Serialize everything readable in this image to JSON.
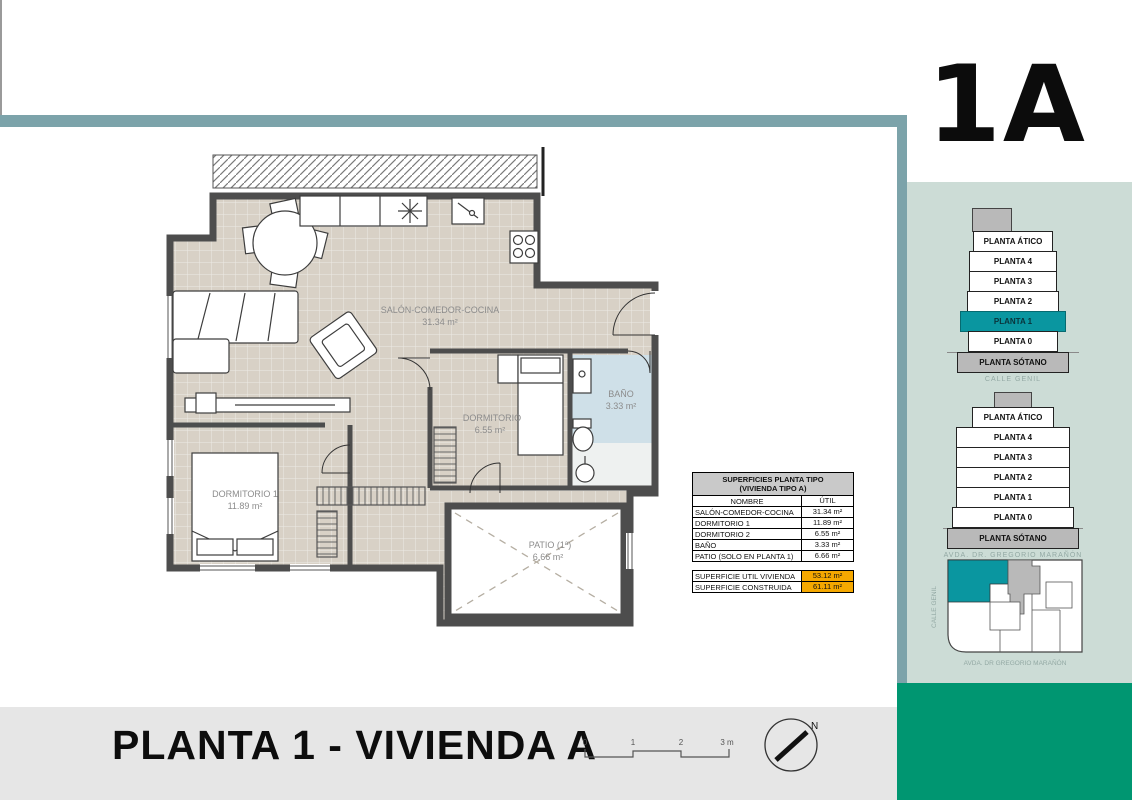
{
  "unit_label": "1A",
  "sheet_title": "PLANTA 1 - VIVIENDA A",
  "plan": {
    "rooms": [
      {
        "name": "SALÓN-COMEDOR-COCINA",
        "area": "31.34 m²"
      },
      {
        "name": "DORMITORIO",
        "area": "6.55 m²"
      },
      {
        "name": "DORMITORIO 1",
        "area": "11.89 m²"
      },
      {
        "name": "BAÑO",
        "area": "3.33 m²"
      },
      {
        "name": "PATIO (1ª)",
        "area": "6.66 m²"
      }
    ]
  },
  "table": {
    "title_line1": "SUPERFICIES PLANTA TIPO",
    "title_line2": "(VIVIENDA TIPO A)",
    "col_name": "NOMBRE",
    "col_util": "ÚTIL",
    "rows": [
      {
        "name": "SALÓN-COMEDOR-COCINA",
        "util": "31.34 m²"
      },
      {
        "name": "DORMITORIO 1",
        "util": "11.89 m²"
      },
      {
        "name": "DORMITORIO 2",
        "util": "6.55 m²"
      },
      {
        "name": "BAÑO",
        "util": "3.33 m²"
      },
      {
        "name": "PATIO (SOLO EN PLANTA 1)",
        "util": "6.66 m²"
      }
    ],
    "totals": [
      {
        "label": "SUPERFICIE UTIL VIVIENDA",
        "value": "53.12 m²"
      },
      {
        "label": "SUPERFICIE CONSTRUIDA",
        "value": "61.11 m²"
      }
    ]
  },
  "sidebar": {
    "stack1": {
      "floors": [
        {
          "label": "PLANTA ÁTICO"
        },
        {
          "label": "PLANTA 4"
        },
        {
          "label": "PLANTA 3"
        },
        {
          "label": "PLANTA 2"
        },
        {
          "label": "PLANTA 1"
        },
        {
          "label": "PLANTA 0"
        },
        {
          "label": "PLANTA SÓTANO"
        }
      ],
      "caption": "CALLE GENIL"
    },
    "stack2": {
      "floors": [
        {
          "label": "PLANTA ÁTICO"
        },
        {
          "label": "PLANTA 4"
        },
        {
          "label": "PLANTA 3"
        },
        {
          "label": "PLANTA 2"
        },
        {
          "label": "PLANTA 1"
        },
        {
          "label": "PLANTA 0"
        },
        {
          "label": "PLANTA SÓTANO"
        }
      ],
      "caption": "AVDA. DR. GREGORIO MARAÑÓN"
    },
    "siteplan": {
      "street_left": "CALLE GENIL",
      "street_bottom": "AVDA. DR GREGORIO MARAÑÓN"
    }
  },
  "scalebar": {
    "labels": [
      "0",
      "1",
      "2",
      "3 m"
    ]
  },
  "north_label": "N",
  "colors": {
    "frame_teal": "#7ca3aa",
    "panel_green": "#ccdcd6",
    "brand_green": "#009671",
    "highlight_teal": "#0a96a0",
    "accent_orange": "#f5a800",
    "floor_beige": "#d8d1c6",
    "bath_blue": "#cfe0e8",
    "wall_gray": "#4d4d4d"
  }
}
